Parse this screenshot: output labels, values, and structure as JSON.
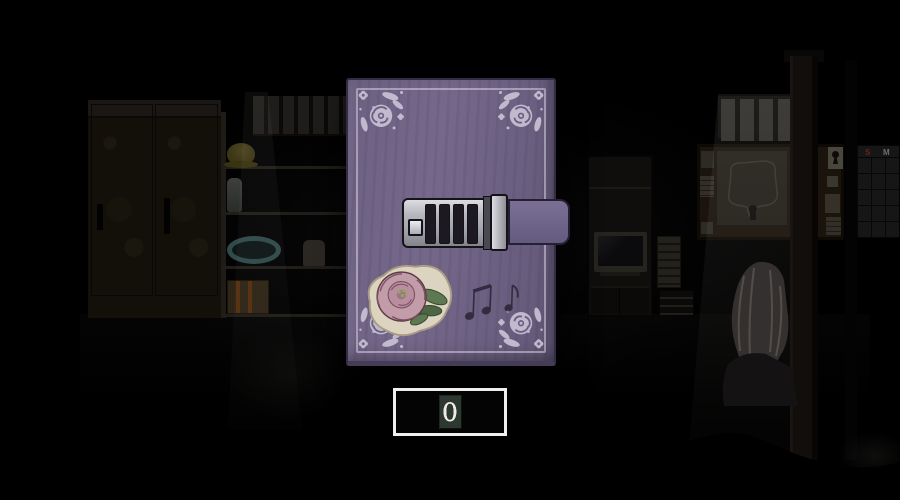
{
  "scene": {
    "objects": [
      "wardrobe",
      "storage-shelf",
      "tv-shelf",
      "bulletin-board",
      "wall-map",
      "barred-window",
      "wall-calendar",
      "wooden-pole",
      "sitting-character",
      "light-beams",
      "foreground-silhouette"
    ],
    "calendar": {
      "visible_headers": [
        "S",
        "M"
      ]
    }
  },
  "diary": {
    "lock_dials": 4,
    "decorations": [
      "corner-floral-stencil",
      "rose-sticker",
      "music-notes-doodle"
    ]
  },
  "code_input": {
    "digits": [
      "0",
      "0",
      "0",
      "0"
    ],
    "selected_index": 0
  },
  "colors": {
    "cover": "#6d6183",
    "cover_dark": "#4f4663",
    "ornament": "#c9c2d5",
    "strap": "#7b7094",
    "strap_dark": "#645a80",
    "metal_light": "#dddce1",
    "metal_dark": "#84838c",
    "outline": "#15131a",
    "sticker_bg": "#dcd4c0",
    "rose_petal": "#c29ca9",
    "rose_petal_dark": "#9d7486",
    "rose_leaf": "#5e7852",
    "code_border": "#efefef",
    "code_digit": "#efece5",
    "code_highlight_bg": "#2d3831"
  }
}
